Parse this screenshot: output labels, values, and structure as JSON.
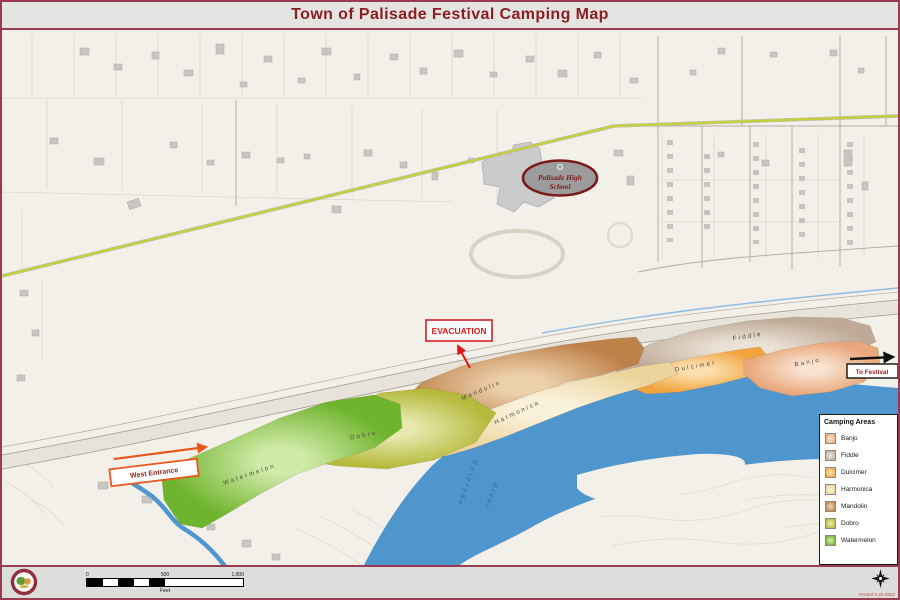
{
  "title": "Town of Palisade Festival Camping Map",
  "legend": {
    "title": "Camping Areas",
    "items": [
      {
        "id": "banjo",
        "label": "Banjo",
        "color": "#E9A87C",
        "color_light": "#F9E2D0"
      },
      {
        "id": "fiddle",
        "label": "Fiddle",
        "color": "#BFAA97",
        "color_light": "#EBE2D7"
      },
      {
        "id": "dulcimer",
        "label": "Dulcimer",
        "color": "#F1A43E",
        "color_light": "#FBDFAE"
      },
      {
        "id": "harmonica",
        "label": "Harmonica",
        "color": "#ECD59C",
        "color_light": "#FAF1DB"
      },
      {
        "id": "mandolin",
        "label": "Mandolin",
        "color": "#BE8148",
        "color_light": "#EDD0AC"
      },
      {
        "id": "dobro",
        "label": "Dobro",
        "color": "#B6BA3C",
        "color_light": "#E7E9B0"
      },
      {
        "id": "watermelon",
        "label": "Watermelon",
        "color": "#6FB42D",
        "color_light": "#D0EAA8"
      }
    ]
  },
  "annotations": {
    "evacuation": "EVACUATION",
    "west_entrance": "West Entrance",
    "to_festival": "To Festival",
    "school_name_line1": "Palisade High",
    "school_name_line2": "School",
    "river_name_line1": "Colorado",
    "river_name_line2": "River"
  },
  "scalebar": {
    "zero": "0",
    "mid": "500",
    "max": "1,000",
    "unit": "Feet"
  },
  "footer": {
    "printed_note": "Printed 5-26-2022"
  },
  "colors": {
    "frame": "#9A3B52",
    "title_text": "#8C1E22",
    "river": "#5096CE",
    "highlight_road": "#C6D22F",
    "evacuation_red": "#E01818",
    "entrance_orange": "#E8571E"
  }
}
